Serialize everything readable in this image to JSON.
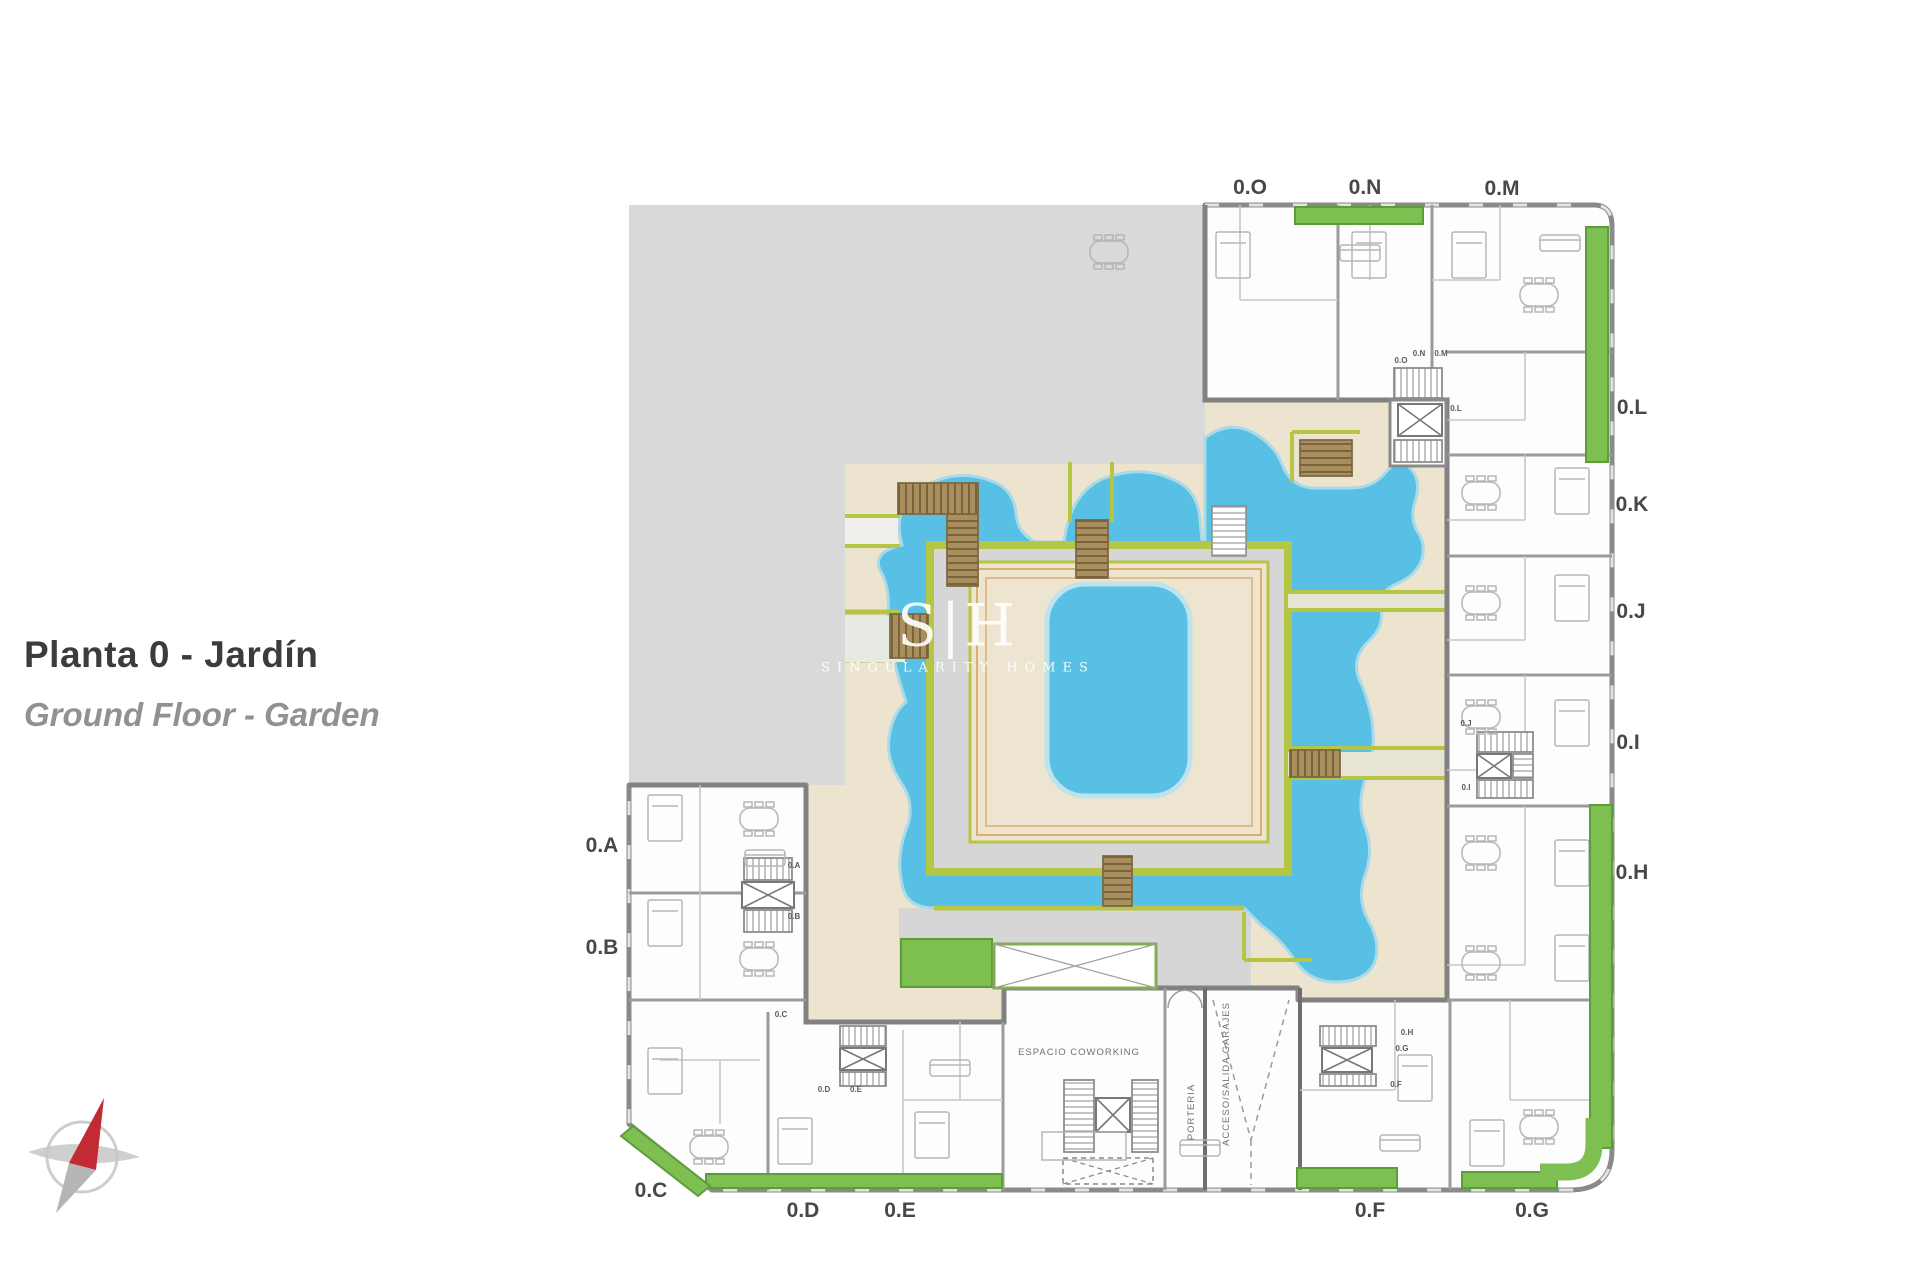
{
  "title": {
    "primary": "Planta 0 - Jardín",
    "secondary": "Ground Floor - Garden"
  },
  "watermark": {
    "logo": "S|H",
    "brand": "SINGULARITY HOMES"
  },
  "palette": {
    "pool_blue": "#57c0e4",
    "pool_rim": "#aadae8",
    "deck_cream": "#ece4cf",
    "island_cream": "#ede5d0",
    "deck_border_orange": "#d8a05c",
    "edge_green_yellow": "#b5c647",
    "grass_green": "#7ebf52",
    "grass_border": "#5d9c3b",
    "vacant_plot_gray": "#d9d9d9",
    "path_gray": "#d6d6d6",
    "wall_gray": "#8a8a8a",
    "wood_brown": "#a98f5e",
    "wood_stripe": "#6d5932",
    "compass_red": "#c22b33",
    "title_text": "#3c3c3f",
    "subtitle_text": "#919193",
    "label_text": "#47474a"
  },
  "floor_plan": {
    "unit_labels": [
      {
        "text": "0.O",
        "x": 1250,
        "y": 194
      },
      {
        "text": "0.N",
        "x": 1365,
        "y": 194
      },
      {
        "text": "0.M",
        "x": 1502,
        "y": 195
      },
      {
        "text": "0.L",
        "x": 1632,
        "y": 414
      },
      {
        "text": "0.K",
        "x": 1632,
        "y": 511
      },
      {
        "text": "0.J",
        "x": 1631,
        "y": 618
      },
      {
        "text": "0.I",
        "x": 1628,
        "y": 749
      },
      {
        "text": "0.H",
        "x": 1632,
        "y": 879
      },
      {
        "text": "0.A",
        "x": 602,
        "y": 852
      },
      {
        "text": "0.B",
        "x": 602,
        "y": 954
      },
      {
        "text": "0.C",
        "x": 651,
        "y": 1197
      },
      {
        "text": "0.D",
        "x": 803,
        "y": 1217
      },
      {
        "text": "0.E",
        "x": 900,
        "y": 1217
      },
      {
        "text": "0.F",
        "x": 1370,
        "y": 1217
      },
      {
        "text": "0.G",
        "x": 1532,
        "y": 1217
      }
    ],
    "small_labels": [
      {
        "text": "0.O",
        "x": 1401,
        "y": 363
      },
      {
        "text": "0.N",
        "x": 1419,
        "y": 356
      },
      {
        "text": "0.M",
        "x": 1441,
        "y": 356
      },
      {
        "text": "0.L",
        "x": 1456,
        "y": 411
      },
      {
        "text": "0.A",
        "x": 794,
        "y": 868
      },
      {
        "text": "0.B",
        "x": 794,
        "y": 919
      },
      {
        "text": "0.C",
        "x": 781,
        "y": 1017
      },
      {
        "text": "0.D",
        "x": 824,
        "y": 1092
      },
      {
        "text": "0.E",
        "x": 856,
        "y": 1092
      },
      {
        "text": "0.J",
        "x": 1466,
        "y": 726
      },
      {
        "text": "0.I",
        "x": 1466,
        "y": 790
      },
      {
        "text": "0.H",
        "x": 1407,
        "y": 1035
      },
      {
        "text": "0.G",
        "x": 1402,
        "y": 1051
      },
      {
        "text": "0.F",
        "x": 1396,
        "y": 1087
      }
    ],
    "area_labels": [
      {
        "text": "ESPACIO COWORKING",
        "x": 1079,
        "y": 1055,
        "rotate": 0,
        "size": 9.5
      },
      {
        "text": "PORTERIA",
        "x": 1194,
        "y": 1112,
        "rotate": -90,
        "size": 8.5
      },
      {
        "text": "ACCESO/SALIDA GARAJES",
        "x": 1229,
        "y": 1074,
        "rotate": -90,
        "size": 8.5
      }
    ]
  },
  "icons": {
    "compass": "north-arrow-compass"
  }
}
